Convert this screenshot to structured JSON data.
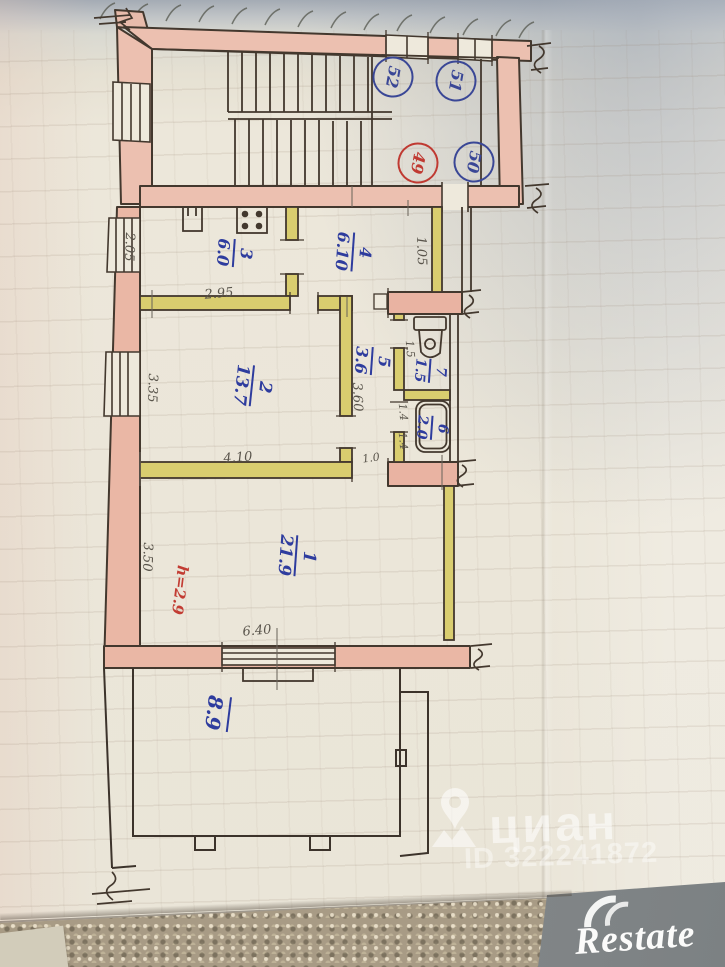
{
  "plan": {
    "apartments": [
      {
        "num": "52"
      },
      {
        "num": "51"
      },
      {
        "num": "49"
      },
      {
        "num": "50"
      }
    ],
    "rooms": {
      "r1": {
        "num": "1",
        "area": "21.9"
      },
      "r2": {
        "num": "2",
        "area": "13.7"
      },
      "r3": {
        "num": "3",
        "area": "6.0"
      },
      "r4": {
        "num": "4",
        "area": "6.10"
      },
      "r5": {
        "num": "5",
        "area": "3.6"
      },
      "r6": {
        "num": "6",
        "area": "2.0"
      },
      "r7": {
        "num": "7",
        "area": "1.5"
      },
      "veranda": {
        "area": "8.9"
      }
    },
    "dims": {
      "kitchen_w": "2.05",
      "kitchen_l": "2.95",
      "hall_w": "1.05",
      "room2_w": "3.35",
      "room2_l": "4.10",
      "corridor_l": "3.60",
      "wc_l": "1.5",
      "bath_w": "1.4",
      "bath_l": "1.4",
      "room1_w": "3.50",
      "room1_l": "6.40",
      "door_w": "1.0",
      "ceiling_h": "h=2.9"
    }
  },
  "watermark": {
    "brand": "циан",
    "listing_id": "ID 322241872"
  },
  "footer": {
    "logo": "Restate"
  },
  "colors": {
    "ink_blue": "#2e3c9e",
    "ink_red": "#c23c33",
    "pencil": "#59544b",
    "wall_pink": "#ecc0b0",
    "partition_yellow": "#d9cd6f"
  }
}
